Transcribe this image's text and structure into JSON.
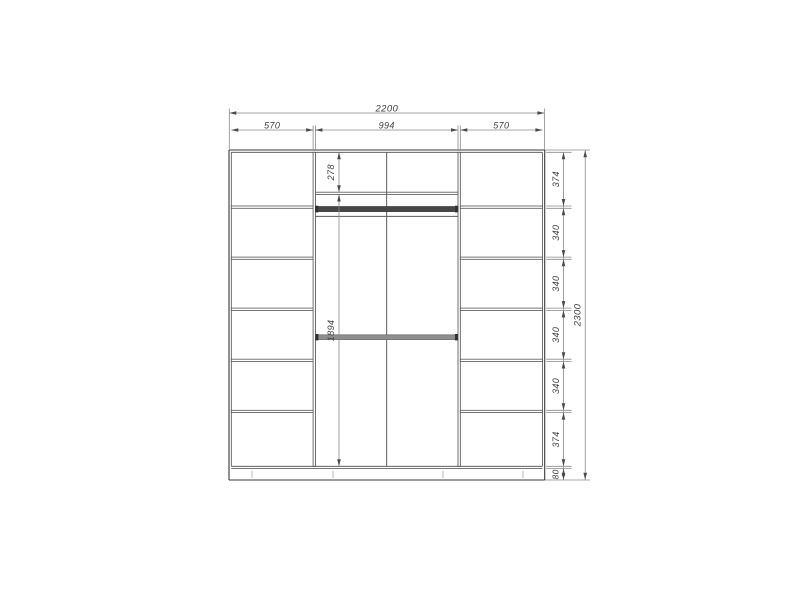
{
  "drawing": {
    "type": "wardrobe-front-elevation-dimension-drawing",
    "overall_width_label": "2200",
    "overall_height_label": "2300",
    "top_width_labels": [
      "570",
      "994",
      "570"
    ],
    "right_height_labels": [
      "374",
      "340",
      "340",
      "340",
      "340",
      "374",
      "80"
    ],
    "middle_height_labels": [
      "278",
      "1894"
    ],
    "numeric": {
      "total_width_mm": 2200,
      "total_height_mm": 2300,
      "bay_widths_mm": [
        570,
        994,
        570
      ],
      "right_segments_mm": [
        374,
        340,
        340,
        340,
        340,
        374
      ],
      "plinth_mm": 80,
      "top_shelf_offset_mm": 278,
      "opening_height_mm": 1894,
      "panel_mm": 16
    },
    "colors": {
      "outline": "#383838",
      "panel": "#4c4c4c",
      "dim_line": "#8a8a8a",
      "arrow": "#4a4a4a",
      "text": "#3f3f3f",
      "rod_dark": "#474747",
      "rod_gray": "#8e8e8e",
      "rod_cap": "#333333",
      "tick": "#b8b8b8",
      "background": "#ffffff"
    }
  }
}
